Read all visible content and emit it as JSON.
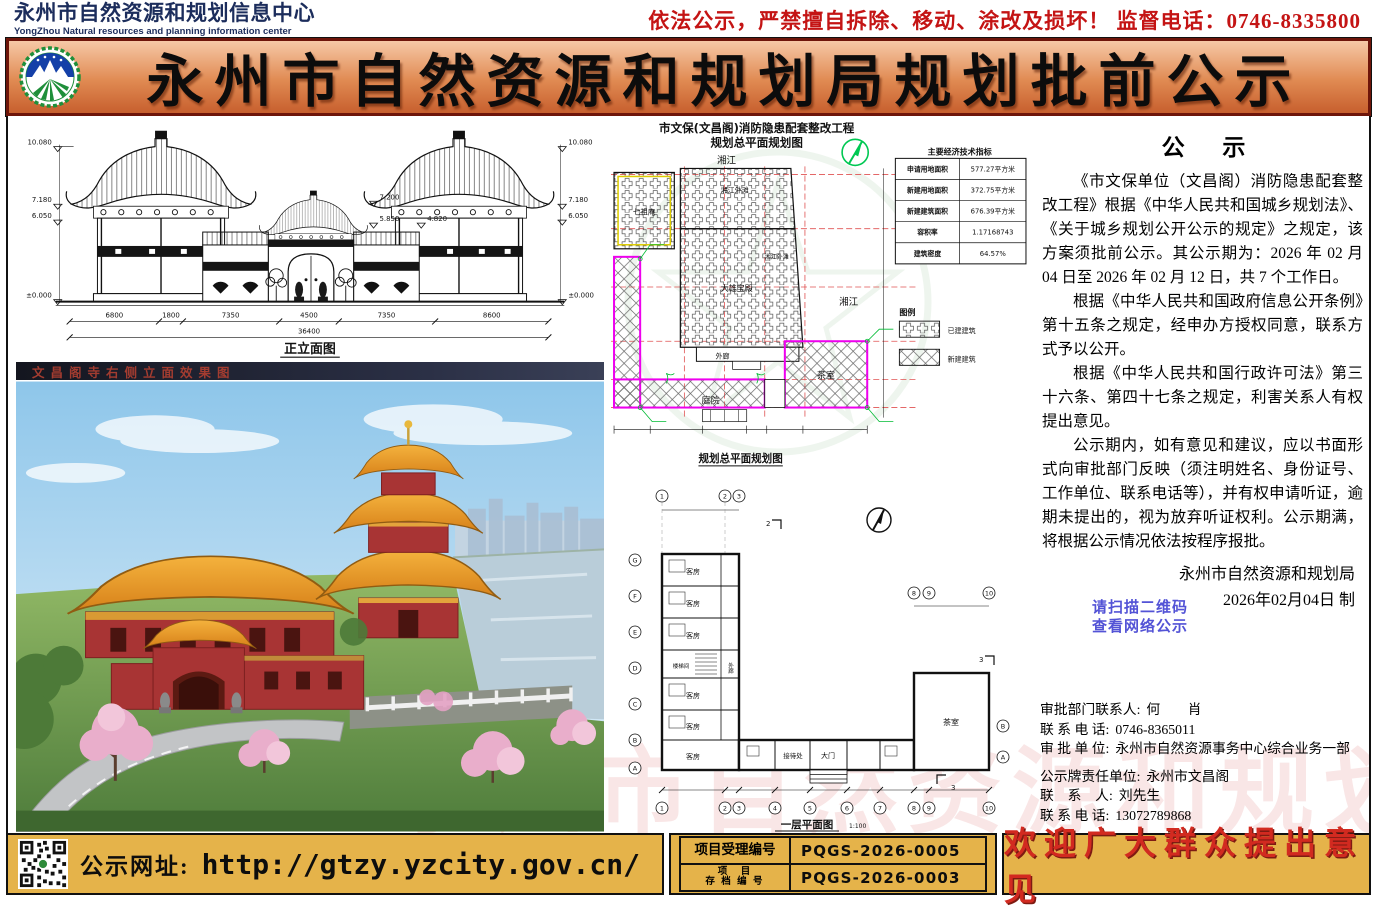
{
  "header": {
    "org_cn": "永州市自然资源和规划信息中心",
    "org_en": "YongZhou Natural resources and planning information center",
    "warning": "依法公示，严禁擅自拆除、移动、涂改及损坏！ 监督电话：0746-8335800"
  },
  "banner": {
    "title": "永州市自然资源和规划局规划批前公示"
  },
  "elevation": {
    "caption": "正立面图",
    "dims": [
      "6800",
      "1800",
      "7350",
      "4500",
      "7350",
      "8600"
    ],
    "total": "36400",
    "levels_left": [
      "10.080",
      "7.180",
      "6.050",
      "±0.000"
    ],
    "levels_right": [
      "10.080",
      "7.180",
      "6.050",
      "±0.000"
    ],
    "levels_mid": [
      "7.200",
      "5.850",
      "4.820"
    ]
  },
  "rendering": {
    "caption": "文昌阁寺右侧立面效果图"
  },
  "siteplan": {
    "title1": "市文保(文昌阁)消防隐患配套整改工程",
    "title2": "规划总平面规划图",
    "caption": "规划总平面规划图",
    "river_top": "湘江",
    "river_right": "湘江",
    "b_qizuan": "七祖庵",
    "b_waitan": "湘江外滩",
    "b_waitan2": "湘江外滩",
    "b_daxiong": "大雄宝殿",
    "b_wailang": "外廊",
    "b_tingyuan": "庭院",
    "b_chashi": "茶室",
    "legend_title": "图例",
    "legend_existing": "已建建筑",
    "legend_new": "新建建筑",
    "table": {
      "title": "主要经济技术指标",
      "rows": [
        [
          "申请用地面积",
          "577.27平方米"
        ],
        [
          "新建用地面积",
          "372.75平方米"
        ],
        [
          "新建建筑面积",
          "676.39平方米"
        ],
        [
          "容积率",
          "1.17168743"
        ],
        [
          "建筑密度",
          "64.57%"
        ]
      ]
    }
  },
  "floorplan": {
    "caption": "一层平面图",
    "scale": "1:100",
    "rooms": {
      "guest": "客房",
      "stair": "楼梯间",
      "corridor": "外廊",
      "reception": "接待处",
      "gate": "大门",
      "tea": "茶室"
    },
    "grid_cols": [
      "1",
      "2",
      "3",
      "4",
      "5",
      "6",
      "7",
      "8",
      "9",
      "10"
    ],
    "grid_rows": [
      "A",
      "B",
      "C",
      "D",
      "E",
      "F",
      "G"
    ],
    "section_marks": [
      "2",
      "3"
    ]
  },
  "notice": {
    "title": "公  示",
    "p": [
      "《市文保单位（文昌阁）消防隐患配套整改工程》根据《中华人民共和国城乡规划法》、《关于城乡规划公开公示的规定》之规定，该方案须批前公示。其公示期为：2026 年 02 月 04 日至 2026 年 02 月 12 日，共 7 个工作日。",
      "根据《中华人民共和国政府信息公开条例》第十五条之规定，经申办方授权同意，联系方式予以公开。",
      "根据《中华人民共和国行政许可法》第三十六条、第四十七条之规定，利害关系人有权提出意见。",
      "公示期内，如有意见和建议，应以书面形式向审批部门反映（须注明姓名、身份证号、工作单位、联系电话等），并有权申请听证，逾期未提出的，视为放弃听证权利。公示期满，将根据公示情况依法按程序报批。"
    ],
    "org": "永州市自然资源和规划局",
    "date": "2026年02月04日  制"
  },
  "qr_hint": {
    "line1": "请扫描二维码",
    "line2": "查看网络公示"
  },
  "contacts": {
    "approval": [
      {
        "label": "审批部门联系人:",
        "value": "何　　肖"
      },
      {
        "label": "联 系 电 话:",
        "value": "0746-8365011"
      },
      {
        "label": "审 批 单 位:",
        "value": "永州市自然资源事务中心综合业务一部"
      }
    ],
    "board": [
      {
        "label": "公示牌责任单位:",
        "value": "永州市文昌阁"
      },
      {
        "label": "联　系　人:",
        "value": "刘先生"
      },
      {
        "label": "联 系 电 话:",
        "value": "13072789868"
      }
    ]
  },
  "footer": {
    "website_label": "公示网址:",
    "website_url": "http://gtzy.yzcity.gov.cn/",
    "rows": [
      {
        "label": "项目受理编号",
        "value": "PQGS-2026-0005"
      },
      {
        "label1": "项　目",
        "label2": "存 档 编 号",
        "value": "PQGS-2026-0003"
      }
    ],
    "welcome": "欢迎广大群众提出意见"
  },
  "watermarks": {
    "cn": "永州市自然资源和规划信息中心",
    "en": "natural resources and planning information center"
  },
  "colors": {
    "banner_orange": "#e08a52",
    "gold": "#e5b34a",
    "warning_red": "#c41414",
    "navy": "#1c2d5c",
    "magenta": "#ee00ee",
    "welcome_red": "#d22a20",
    "notice_blue": "#5353d6"
  }
}
